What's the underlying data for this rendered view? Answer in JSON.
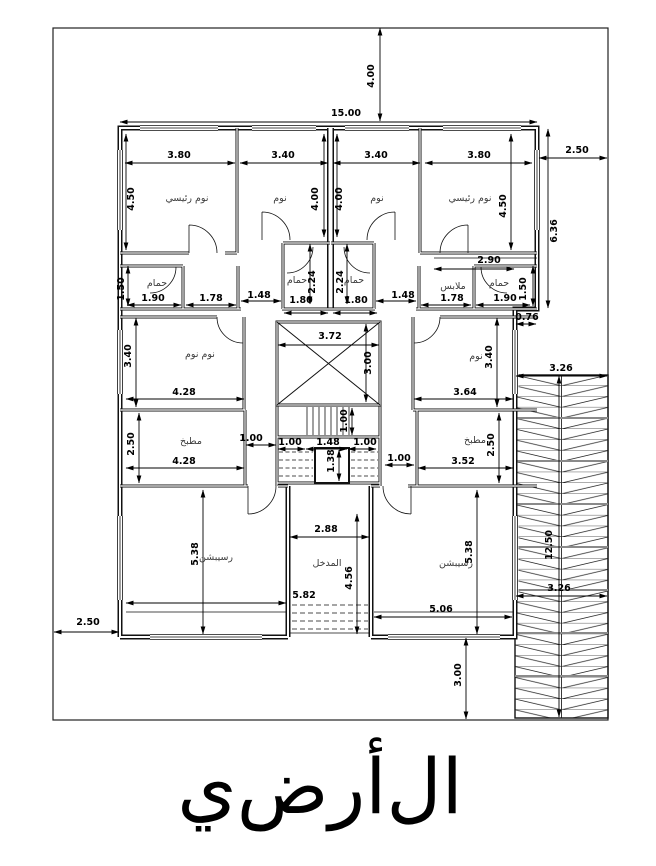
{
  "title": {
    "text": "ال‌أرض‌ي"
  },
  "rooms": [
    {
      "text": "نوم رئيسي",
      "x": 187,
      "y": 201
    },
    {
      "text": "نوم",
      "x": 280,
      "y": 201
    },
    {
      "text": "نوم",
      "x": 377,
      "y": 201
    },
    {
      "text": "نوم رئيسي",
      "x": 470,
      "y": 201
    },
    {
      "text": "حمام",
      "x": 157,
      "y": 286
    },
    {
      "text": "حمام",
      "x": 297,
      "y": 283
    },
    {
      "text": "حمام",
      "x": 354,
      "y": 283
    },
    {
      "text": "حمام",
      "x": 499,
      "y": 286
    },
    {
      "text": "ملابس",
      "x": 453,
      "y": 289
    },
    {
      "text": "نوم نوم",
      "x": 200,
      "y": 357
    },
    {
      "text": "نوم",
      "x": 476,
      "y": 359
    },
    {
      "text": "مطبخ",
      "x": 191,
      "y": 444
    },
    {
      "text": "مطبخ",
      "x": 475,
      "y": 443
    },
    {
      "text": "رسيبشن",
      "x": 216,
      "y": 560
    },
    {
      "text": "رسيبشن",
      "x": 456,
      "y": 566
    },
    {
      "text": "المدخل",
      "x": 327,
      "y": 566
    }
  ],
  "dimensions": [
    {
      "text": "4.00",
      "tx": 374,
      "ty": 76,
      "rot": -90,
      "x1": 380,
      "y1": 28,
      "x2": 380,
      "y2": 121
    },
    {
      "text": "15.00",
      "tx": 346,
      "ty": 116,
      "rot": 0,
      "x1": 120,
      "y1": 122,
      "x2": 537,
      "y2": 122
    },
    {
      "text": "2.50",
      "tx": 577,
      "ty": 153,
      "rot": 0,
      "x1": 539,
      "y1": 158,
      "x2": 607,
      "y2": 158
    },
    {
      "text": "6.36",
      "tx": 557,
      "ty": 231,
      "rot": -90,
      "x1": 548,
      "y1": 129,
      "x2": 548,
      "y2": 308
    },
    {
      "text": "3.80",
      "tx": 179,
      "ty": 158,
      "rot": 0,
      "x1": 125,
      "y1": 163,
      "x2": 235,
      "y2": 163
    },
    {
      "text": "3.40",
      "tx": 283,
      "ty": 158,
      "rot": 0,
      "x1": 240,
      "y1": 163,
      "x2": 328,
      "y2": 163
    },
    {
      "text": "3.40",
      "tx": 376,
      "ty": 158,
      "rot": 0,
      "x1": 333,
      "y1": 163,
      "x2": 420,
      "y2": 163
    },
    {
      "text": "3.80",
      "tx": 479,
      "ty": 158,
      "rot": 0,
      "x1": 425,
      "y1": 163,
      "x2": 532,
      "y2": 163
    },
    {
      "text": "4.50",
      "tx": 134,
      "ty": 199,
      "rot": -90,
      "x1": 126,
      "y1": 134,
      "x2": 126,
      "y2": 250
    },
    {
      "text": "4.00",
      "tx": 318,
      "ty": 199,
      "rot": -90,
      "x1": 324,
      "y1": 134,
      "x2": 324,
      "y2": 237
    },
    {
      "text": "4.00",
      "tx": 342,
      "ty": 199,
      "rot": -90,
      "x1": 337,
      "y1": 134,
      "x2": 337,
      "y2": 237
    },
    {
      "text": "4.50",
      "tx": 506,
      "ty": 206,
      "rot": -90,
      "x1": 511,
      "y1": 134,
      "x2": 511,
      "y2": 250
    },
    {
      "text": "2.90",
      "tx": 489,
      "ty": 263,
      "rot": 0,
      "x1": 434,
      "y1": 269,
      "x2": 514,
      "y2": 269
    },
    {
      "text": "1.50",
      "tx": 124,
      "ty": 289,
      "rot": -90,
      "x1": 128,
      "y1": 266,
      "x2": 128,
      "y2": 306
    },
    {
      "text": "1.90",
      "tx": 153,
      "ty": 301,
      "rot": 0,
      "x1": 127,
      "y1": 305,
      "x2": 181,
      "y2": 305
    },
    {
      "text": "1.78",
      "tx": 211,
      "ty": 301,
      "rot": 0,
      "x1": 186,
      "y1": 305,
      "x2": 236,
      "y2": 305
    },
    {
      "text": "1.48",
      "tx": 259,
      "ty": 298,
      "rot": 0,
      "x1": 241,
      "y1": 301,
      "x2": 281,
      "y2": 301
    },
    {
      "text": "1.80",
      "tx": 301,
      "ty": 303,
      "rot": 0,
      "x1": 284,
      "y1": 313,
      "x2": 328,
      "y2": 313
    },
    {
      "text": "1.80",
      "tx": 356,
      "ty": 303,
      "rot": 0,
      "x1": 333,
      "y1": 313,
      "x2": 377,
      "y2": 313
    },
    {
      "text": "2.24",
      "tx": 315,
      "ty": 282,
      "rot": -90,
      "x1": 310,
      "y1": 244,
      "x2": 310,
      "y2": 304
    },
    {
      "text": "2.24",
      "tx": 343,
      "ty": 282,
      "rot": -90,
      "x1": 347,
      "y1": 244,
      "x2": 347,
      "y2": 304
    },
    {
      "text": "1.48",
      "tx": 403,
      "ty": 298,
      "rot": 0,
      "x1": 376,
      "y1": 301,
      "x2": 416,
      "y2": 301
    },
    {
      "text": "1.78",
      "tx": 452,
      "ty": 301,
      "rot": 0,
      "x1": 421,
      "y1": 305,
      "x2": 471,
      "y2": 305
    },
    {
      "text": "1.90",
      "tx": 505,
      "ty": 301,
      "rot": 0,
      "x1": 476,
      "y1": 305,
      "x2": 530,
      "y2": 305
    },
    {
      "text": "1.50",
      "tx": 526,
      "ty": 289,
      "rot": -90,
      "x1": 533,
      "y1": 266,
      "x2": 533,
      "y2": 306
    },
    {
      "text": "0.76",
      "tx": 527,
      "ty": 320,
      "rot": 0,
      "x1": 516,
      "y1": 324,
      "x2": 536,
      "y2": 324
    },
    {
      "text": "3.72",
      "tx": 330,
      "ty": 339,
      "rot": 0,
      "x1": 278,
      "y1": 345,
      "x2": 379,
      "y2": 345
    },
    {
      "text": "3.00",
      "tx": 371,
      "ty": 363,
      "rot": -90,
      "x1": 366,
      "y1": 324,
      "x2": 366,
      "y2": 402
    },
    {
      "text": "3.40",
      "tx": 131,
      "ty": 356,
      "rot": -90,
      "x1": 136,
      "y1": 318,
      "x2": 136,
      "y2": 407
    },
    {
      "text": "4.28",
      "tx": 184,
      "ty": 395,
      "rot": 0,
      "x1": 126,
      "y1": 399,
      "x2": 244,
      "y2": 399
    },
    {
      "text": "3.40",
      "tx": 492,
      "ty": 357,
      "rot": -90,
      "x1": 497,
      "y1": 318,
      "x2": 497,
      "y2": 407
    },
    {
      "text": "3.64",
      "tx": 465,
      "ty": 395,
      "rot": 0,
      "x1": 414,
      "y1": 399,
      "x2": 513,
      "y2": 399
    },
    {
      "text": "3.26",
      "tx": 561,
      "ty": 371,
      "rot": 0,
      "x1": 516,
      "y1": 376,
      "x2": 607,
      "y2": 376
    },
    {
      "text": "3.26",
      "tx": 559,
      "ty": 591,
      "rot": 0,
      "x1": 516,
      "y1": 596,
      "x2": 607,
      "y2": 596
    },
    {
      "text": "12.50",
      "tx": 552,
      "ty": 545,
      "rot": -90,
      "x1": 559,
      "y1": 376,
      "x2": 559,
      "y2": 717
    },
    {
      "text": "2.50",
      "tx": 134,
      "ty": 444,
      "rot": -90,
      "x1": 139,
      "y1": 413,
      "x2": 139,
      "y2": 483
    },
    {
      "text": "4.28",
      "tx": 184,
      "ty": 464,
      "rot": 0,
      "x1": 126,
      "y1": 468,
      "x2": 244,
      "y2": 468
    },
    {
      "text": "2.50",
      "tx": 494,
      "ty": 445,
      "rot": -90,
      "x1": 499,
      "y1": 413,
      "x2": 499,
      "y2": 483
    },
    {
      "text": "3.52",
      "tx": 463,
      "ty": 464,
      "rot": 0,
      "x1": 418,
      "y1": 468,
      "x2": 513,
      "y2": 468
    },
    {
      "text": "1.00",
      "tx": 251,
      "ty": 441,
      "rot": 0,
      "x1": 246,
      "y1": 445,
      "x2": 276,
      "y2": 445
    },
    {
      "text": "1.00",
      "tx": 290,
      "ty": 445,
      "rot": 0,
      "x1": 278,
      "y1": 449,
      "x2": 305,
      "y2": 449
    },
    {
      "text": "1.48",
      "tx": 328,
      "ty": 445,
      "rot": 0,
      "x1": 306,
      "y1": 449,
      "x2": 347,
      "y2": 449
    },
    {
      "text": "1.00",
      "tx": 365,
      "ty": 445,
      "rot": 0,
      "x1": 348,
      "y1": 449,
      "x2": 376,
      "y2": 449
    },
    {
      "text": "1.38",
      "tx": 334,
      "ty": 461,
      "rot": -90,
      "x1": 339,
      "y1": 450,
      "x2": 339,
      "y2": 481
    },
    {
      "text": "1.00",
      "tx": 347,
      "ty": 421,
      "rot": -90,
      "x1": 352,
      "y1": 408,
      "x2": 352,
      "y2": 435
    },
    {
      "text": "1.00",
      "tx": 399,
      "ty": 461,
      "rot": 0,
      "x1": 385,
      "y1": 465,
      "x2": 414,
      "y2": 465
    },
    {
      "text": "5.38",
      "tx": 198,
      "ty": 554,
      "rot": -90,
      "x1": 203,
      "y1": 490,
      "x2": 203,
      "y2": 634
    },
    {
      "text": "5.82",
      "tx": 304,
      "ty": 598,
      "rot": 0,
      "x1": 126,
      "y1": 603,
      "x2": 286,
      "y2": 603
    },
    {
      "text": "2.88",
      "tx": 326,
      "ty": 532,
      "rot": 0,
      "x1": 290,
      "y1": 537,
      "x2": 369,
      "y2": 537
    },
    {
      "text": "4.56",
      "tx": 352,
      "ty": 578,
      "rot": -90,
      "x1": 357,
      "y1": 514,
      "x2": 357,
      "y2": 634
    },
    {
      "text": "5.38",
      "tx": 472,
      "ty": 552,
      "rot": -90,
      "x1": 477,
      "y1": 490,
      "x2": 477,
      "y2": 634
    },
    {
      "text": "5.06",
      "tx": 441,
      "ty": 612,
      "rot": 0,
      "x1": 374,
      "y1": 617,
      "x2": 512,
      "y2": 617
    },
    {
      "text": "2.50",
      "tx": 88,
      "ty": 625,
      "rot": 0,
      "x1": 54,
      "y1": 632,
      "x2": 119,
      "y2": 632
    },
    {
      "text": "3.00",
      "tx": 461,
      "ty": 675,
      "rot": -90,
      "x1": 466,
      "y1": 638,
      "x2": 466,
      "y2": 719
    }
  ]
}
